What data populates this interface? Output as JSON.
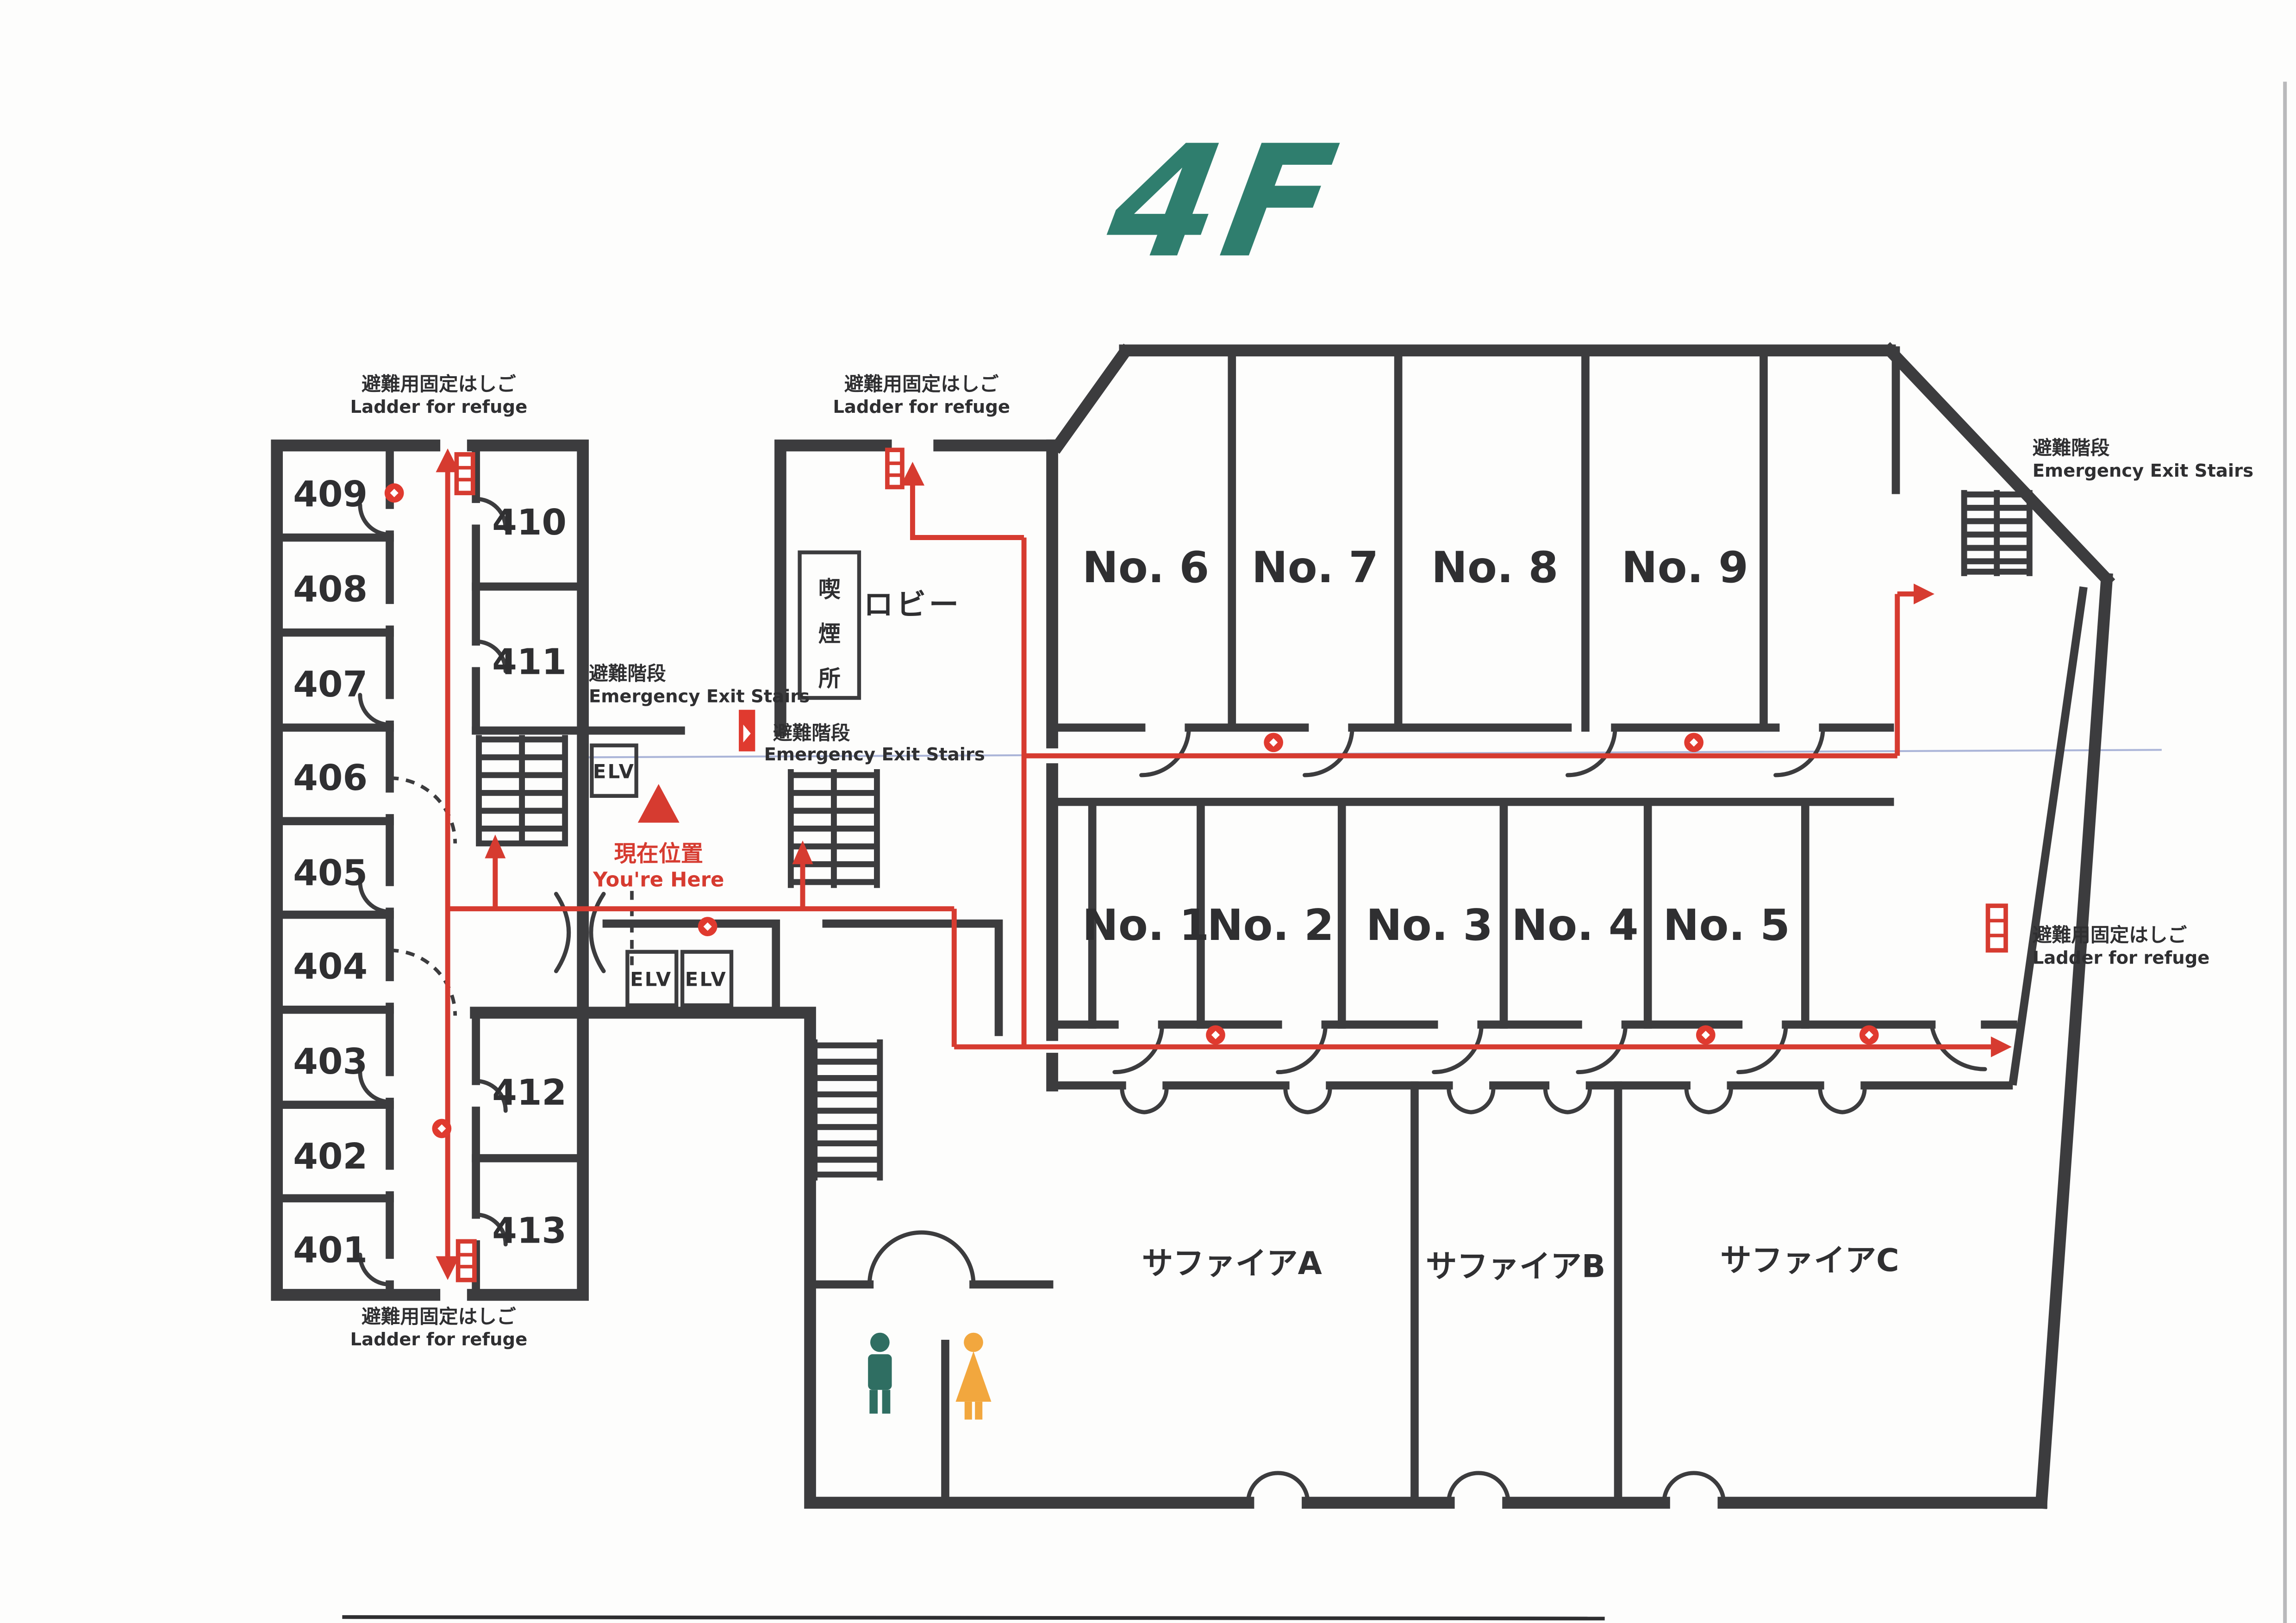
{
  "title": "4F",
  "legend": {
    "ladder": {
      "jp": "避難用固定はしご",
      "en": "Ladder for refuge"
    },
    "exit_stairs": {
      "jp": "避難階段",
      "en": "Emergency Exit Stairs"
    },
    "you_are_here": {
      "jp": "現在位置",
      "en": "You're Here"
    },
    "elevator": "ELV",
    "smoking_area": "喫煙所",
    "lobby": "ロビー"
  },
  "rooms": {
    "guest_left": [
      "409",
      "408",
      "407",
      "406",
      "405",
      "404",
      "403",
      "402",
      "401"
    ],
    "guest_right": [
      "410",
      "411",
      "412",
      "413"
    ],
    "halls_upper": [
      "No. 6",
      "No. 7",
      "No. 8",
      "No. 9"
    ],
    "halls_middle": [
      "No. 1",
      "No. 2",
      "No. 3",
      "No. 4",
      "No. 5"
    ],
    "banquet": [
      "サファイアA",
      "サファイアB",
      "サファイアC"
    ]
  },
  "colors": {
    "title_green": "#2f7e6e",
    "route_red": "#d63b30",
    "wall": "#3c3c3e",
    "male_icon": "#2f6e62",
    "female_icon": "#f2a73e"
  }
}
